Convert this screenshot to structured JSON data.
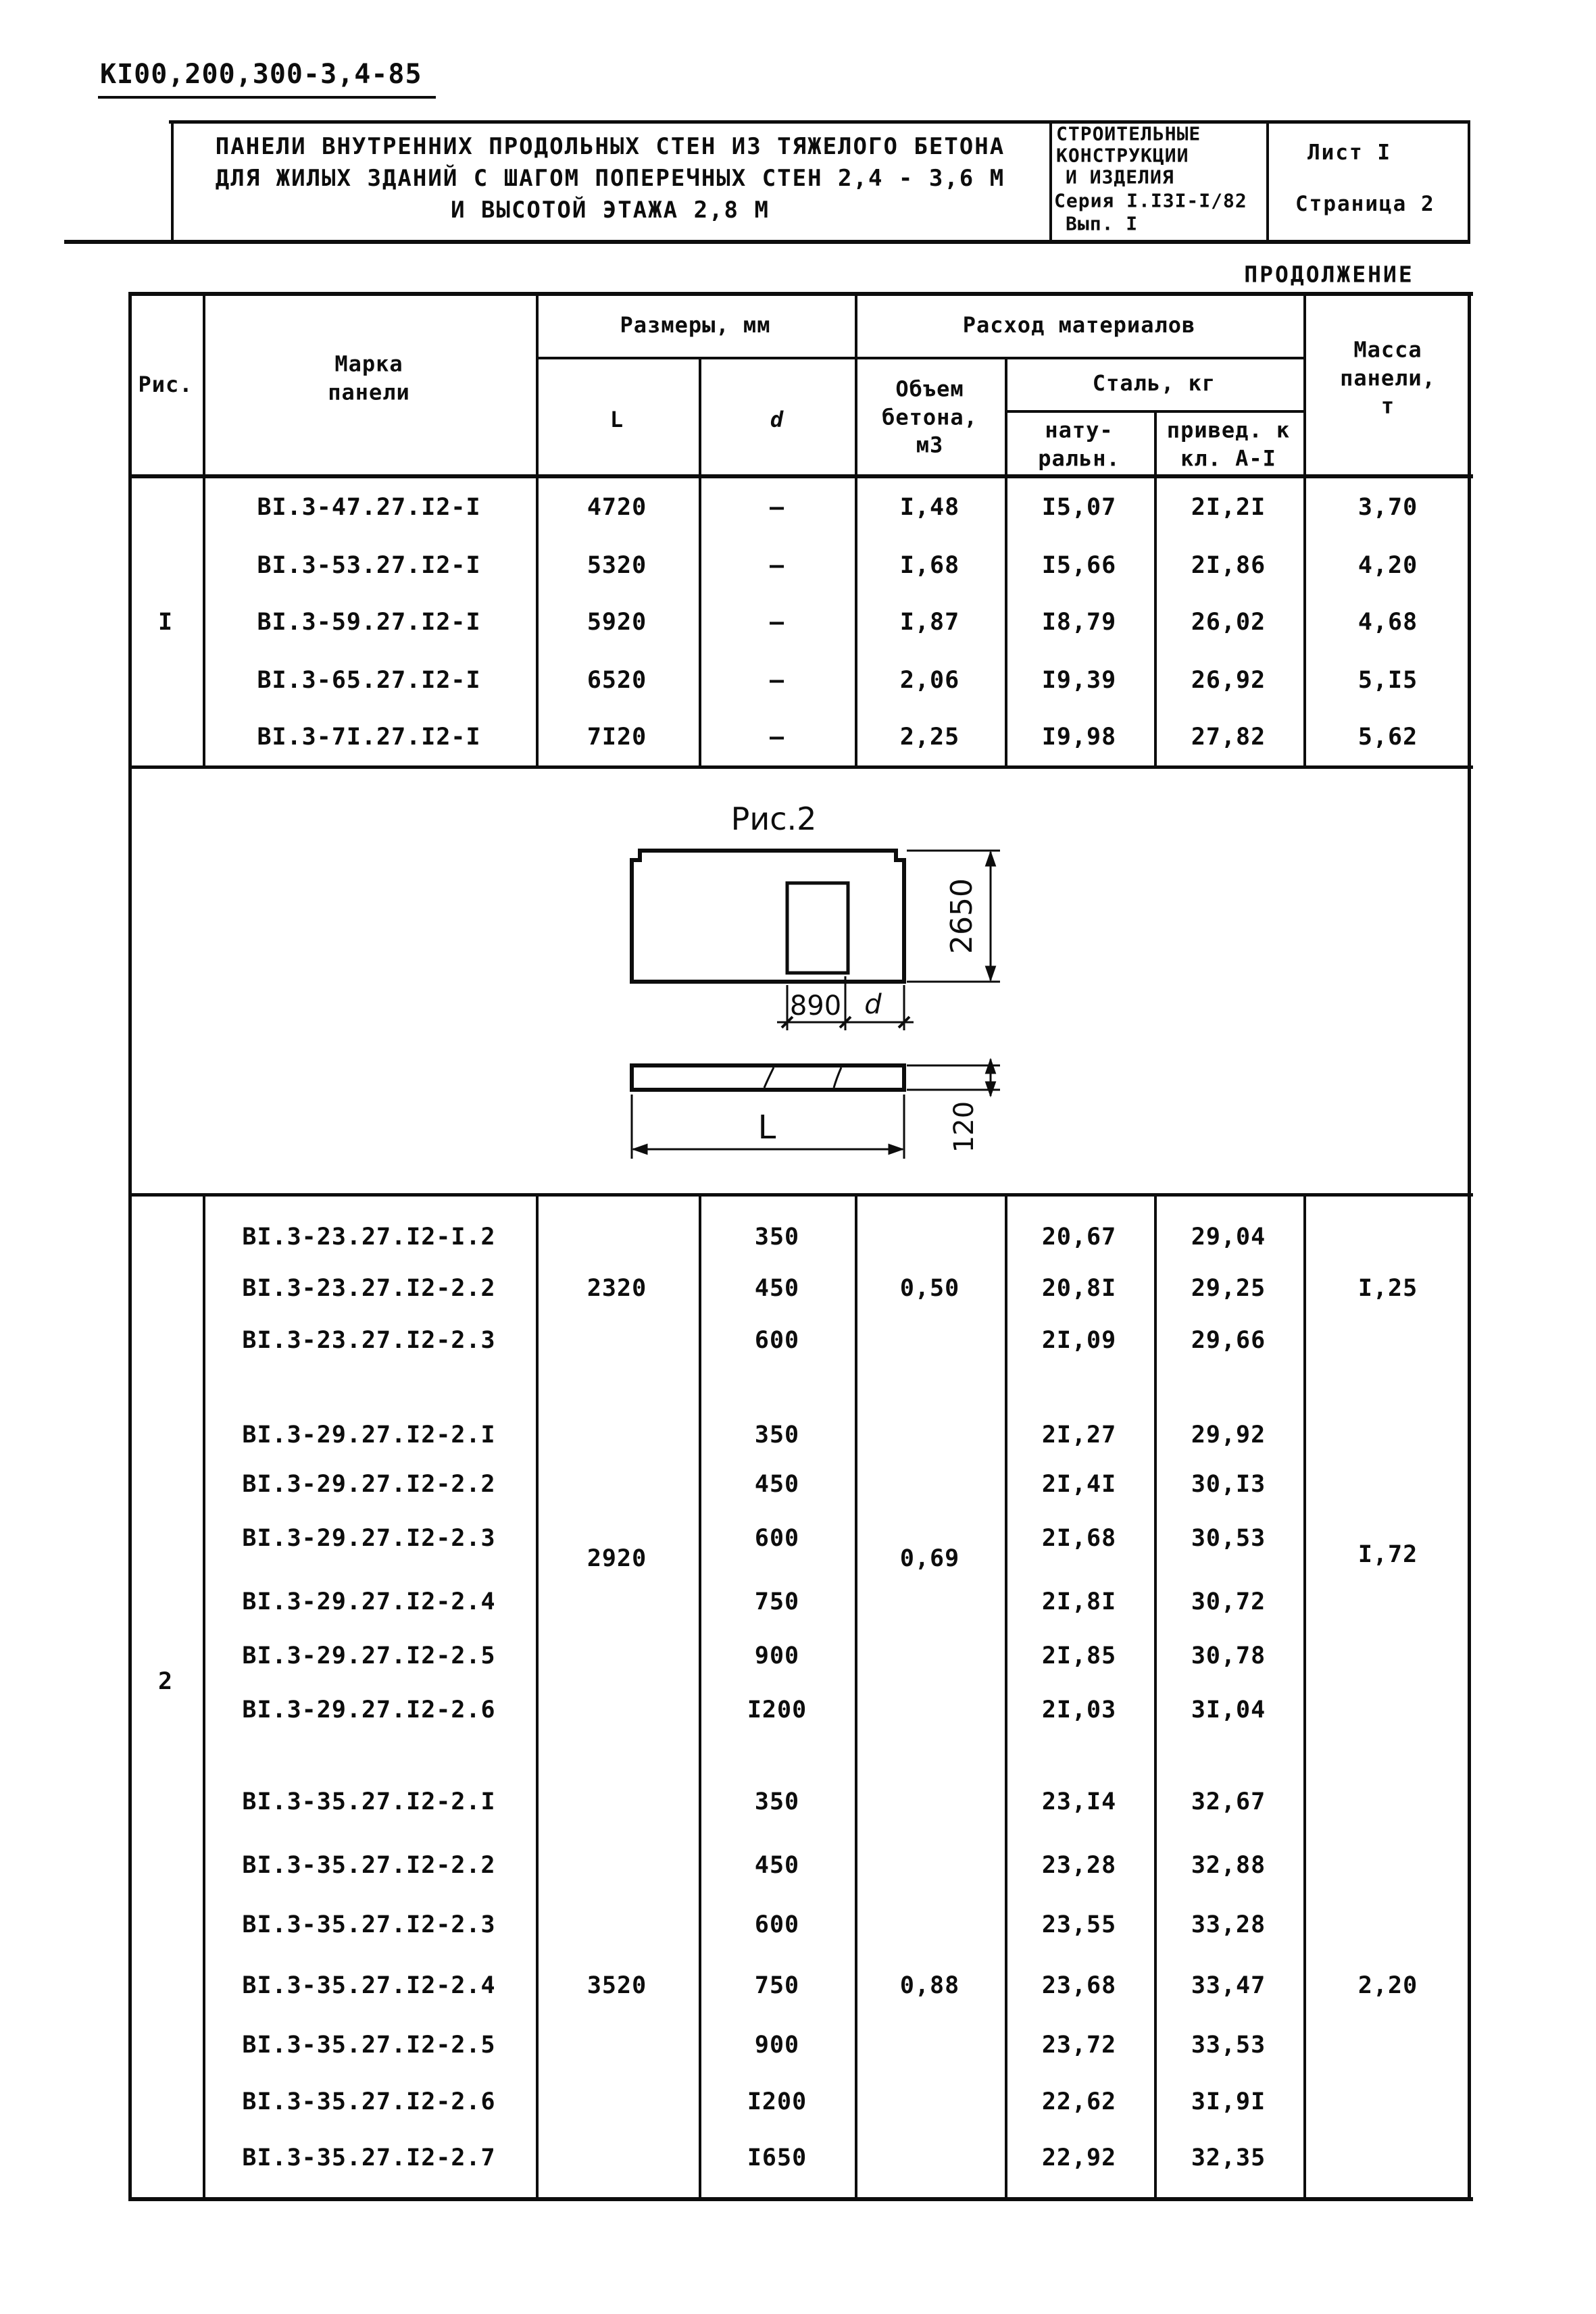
{
  "doc_code": "КI00,200,300-3,4-85",
  "header": {
    "title_line1": "ПАНЕЛИ ВНУТРЕННИХ ПРОДОЛЬНЫХ СТЕН ИЗ ТЯЖЕЛОГО БЕТОНА",
    "title_line2": "ДЛЯ ЖИЛЫХ ЗДАНИЙ С ШАГОМ ПОПЕРЕЧНЫХ СТЕН 2,4 - 3,6 М",
    "title_line3": "И ВЫСОТОЙ ЭТАЖА 2,8 М",
    "series_line1": "СТРОИТЕЛЬНЫЕ",
    "series_line2": "КОНСТРУКЦИИ",
    "series_line3": "И ИЗДЕЛИЯ",
    "series_line4": "Серия I.I3I-I/82",
    "series_line5": "Вып. I",
    "sheet": "Лист I",
    "page": "Страница 2"
  },
  "continuation": "ПРОДОЛЖЕНИЕ",
  "table": {
    "header": {
      "fig": "Рис.",
      "mark": "Марка\nпанели",
      "dims": "Размеры, мм",
      "L": "L",
      "d": "d",
      "materials": "Расход материалов",
      "concrete": "Объем\nбетона,\nм3",
      "steel": "Сталь, кг",
      "steel_nat": "нату-\nральн.",
      "steel_red": "привед. к\nкл. А-I",
      "mass": "Масса\nпанели,\nт"
    },
    "block1": {
      "fig": "I",
      "rows": [
        {
          "mark": "ВI.3-47.27.I2-I",
          "L": "4720",
          "d": "—",
          "vol": "I,48",
          "nat": "I5,07",
          "red": "2I,2I",
          "mass": "3,70"
        },
        {
          "mark": "ВI.3-53.27.I2-I",
          "L": "5320",
          "d": "—",
          "vol": "I,68",
          "nat": "I5,66",
          "red": "2I,86",
          "mass": "4,20"
        },
        {
          "mark": "ВI.3-59.27.I2-I",
          "L": "5920",
          "d": "—",
          "vol": "I,87",
          "nat": "I8,79",
          "red": "26,02",
          "mass": "4,68"
        },
        {
          "mark": "ВI.3-65.27.I2-I",
          "L": "6520",
          "d": "—",
          "vol": "2,06",
          "nat": "I9,39",
          "red": "26,92",
          "mass": "5,I5"
        },
        {
          "mark": "ВI.3-7I.27.I2-I",
          "L": "7I20",
          "d": "—",
          "vol": "2,25",
          "nat": "I9,98",
          "red": "27,82",
          "mass": "5,62"
        }
      ]
    },
    "figure": {
      "caption": "Рис.2",
      "height_dim": "2650",
      "door_width_dim": "890",
      "door_offset_dim": "d",
      "length_dim": "L",
      "thickness_dim": "120"
    },
    "block2": {
      "fig": "2",
      "groups": [
        {
          "L": "2320",
          "vol": "0,50",
          "mass": "I,25",
          "rows": [
            {
              "mark": "ВI.3-23.27.I2-I.2",
              "d": "350",
              "nat": "20,67",
              "red": "29,04"
            },
            {
              "mark": "ВI.3-23.27.I2-2.2",
              "d": "450",
              "nat": "20,8I",
              "red": "29,25"
            },
            {
              "mark": "ВI.3-23.27.I2-2.3",
              "d": "600",
              "nat": "2I,09",
              "red": "29,66"
            }
          ]
        },
        {
          "L": "2920",
          "vol": "0,69",
          "mass": "I,72",
          "rows": [
            {
              "mark": "ВI.3-29.27.I2-2.I",
              "d": "350",
              "nat": "2I,27",
              "red": "29,92"
            },
            {
              "mark": "ВI.3-29.27.I2-2.2",
              "d": "450",
              "nat": "2I,4I",
              "red": "30,I3"
            },
            {
              "mark": "ВI.3-29.27.I2-2.3",
              "d": "600",
              "nat": "2I,68",
              "red": "30,53"
            },
            {
              "mark": "ВI.3-29.27.I2-2.4",
              "d": "750",
              "nat": "2I,8I",
              "red": "30,72"
            },
            {
              "mark": "ВI.3-29.27.I2-2.5",
              "d": "900",
              "nat": "2I,85",
              "red": "30,78"
            },
            {
              "mark": "ВI.3-29.27.I2-2.6",
              "d": "I200",
              "nat": "2I,03",
              "red": "3I,04"
            }
          ]
        },
        {
          "L": "3520",
          "vol": "0,88",
          "mass": "2,20",
          "rows": [
            {
              "mark": "ВI.3-35.27.I2-2.I",
              "d": "350",
              "nat": "23,I4",
              "red": "32,67"
            },
            {
              "mark": "ВI.3-35.27.I2-2.2",
              "d": "450",
              "nat": "23,28",
              "red": "32,88"
            },
            {
              "mark": "ВI.3-35.27.I2-2.3",
              "d": "600",
              "nat": "23,55",
              "red": "33,28"
            },
            {
              "mark": "ВI.3-35.27.I2-2.4",
              "d": "750",
              "nat": "23,68",
              "red": "33,47"
            },
            {
              "mark": "ВI.3-35.27.I2-2.5",
              "d": "900",
              "nat": "23,72",
              "red": "33,53"
            },
            {
              "mark": "ВI.3-35.27.I2-2.6",
              "d": "I200",
              "nat": "22,62",
              "red": "3I,9I"
            },
            {
              "mark": "ВI.3-35.27.I2-2.7",
              "d": "I650",
              "nat": "22,92",
              "red": "32,35"
            }
          ]
        }
      ]
    }
  }
}
